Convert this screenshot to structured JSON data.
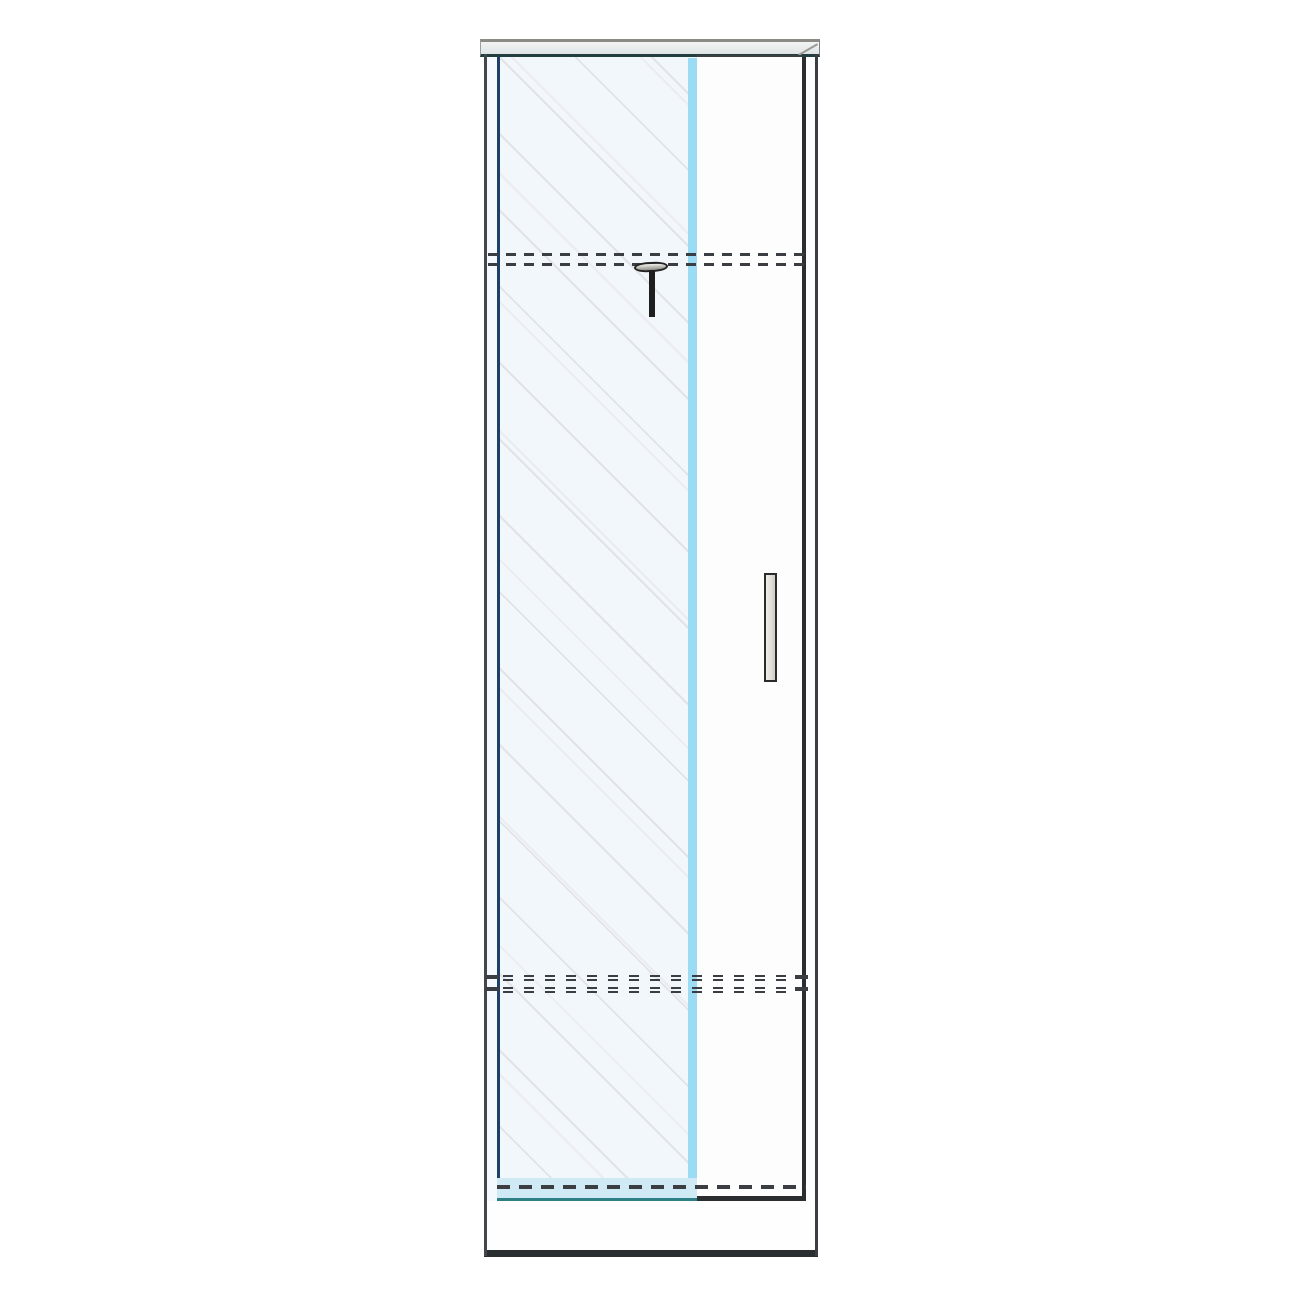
{
  "meta": {
    "description": "Technical line drawing of a tall single wardrobe cabinet with a sliding glass front panel (diagonal hatching), a right-hand hinged door with vertical recessed handle, hidden shelf positions shown as dashed lines, a clothes-rail bracket below the top shelf, a top cap panel and a plinth base.",
    "canvas": {
      "w": 1300,
      "h": 1300,
      "bg": "#ffffff"
    }
  },
  "colors": {
    "outline_dark": "#34383c",
    "navy": "#1d4066",
    "teal": "#2e7f86",
    "glass_fill": "#f2f7fc",
    "glass_band": "#9bdcf4",
    "hatch": "#e2e3e7",
    "cap_fill": "#eaeded",
    "handle_fill": "#e2dfd9",
    "dash": "#3a3e42",
    "rail_blue_fill": "#cfeaf5",
    "white": "#fdfdfd",
    "side_gray": "#43474b"
  },
  "parts": {
    "top_cap": {
      "x": 480,
      "y": 39,
      "w": 340,
      "h": 18
    },
    "cap_bevel": {
      "x": 799,
      "y": 54,
      "w": 22,
      "h": 2
    },
    "left_side_panel": {
      "x": 484,
      "y": 54,
      "w": 3,
      "h": 1202
    },
    "left_side_gap": {
      "x": 487,
      "y": 57,
      "w": 10,
      "h": 1145
    },
    "glass_door": {
      "x": 497,
      "y": 57,
      "w": 200,
      "h": 1145
    },
    "glass_edge_band": {
      "x": 688,
      "y": 58,
      "w": 9,
      "h": 1141
    },
    "right_door": {
      "x": 697,
      "y": 55,
      "w": 105,
      "h": 1147
    },
    "right_inner_edge": {
      "x": 802,
      "y": 57,
      "w": 4,
      "h": 1141
    },
    "right_side_gap": {
      "x": 806,
      "y": 57,
      "w": 9,
      "h": 1145
    },
    "right_side_panel": {
      "x": 815,
      "y": 54,
      "w": 3,
      "h": 1202
    },
    "glass_bottom_rail": {
      "x": 497,
      "y": 1178,
      "w": 200,
      "h": 23
    },
    "right_door_bottom_edge": {
      "x": 697,
      "y": 1196,
      "w": 109,
      "h": 5
    },
    "plinth": {
      "x": 487,
      "y": 1201,
      "w": 328,
      "h": 49
    },
    "bottom_edge": {
      "x": 484,
      "y": 1250,
      "w": 334,
      "h": 7
    },
    "shelf1_dash_upper": {
      "x": 488,
      "y": 253,
      "w": 318,
      "h": 3
    },
    "shelf1_dash_lower": {
      "x": 488,
      "y": 263,
      "w": 318,
      "h": 3
    },
    "shelf2_dash_r1a": {
      "x": 503,
      "y": 975,
      "w": 292,
      "h": 2
    },
    "shelf2_dash_r1b": {
      "x": 503,
      "y": 979,
      "w": 292,
      "h": 2
    },
    "shelf2_dash_r2a": {
      "x": 503,
      "y": 987,
      "w": 292,
      "h": 2
    },
    "shelf2_dash_r2b": {
      "x": 503,
      "y": 991,
      "w": 292,
      "h": 2
    },
    "shelf2_stub_l1": {
      "x": 486,
      "y": 975,
      "w": 13,
      "h": 4
    },
    "shelf2_stub_l2": {
      "x": 486,
      "y": 987,
      "w": 13,
      "h": 4
    },
    "shelf2_stub_r1": {
      "x": 795,
      "y": 975,
      "w": 13,
      "h": 4
    },
    "shelf2_stub_r2": {
      "x": 795,
      "y": 987,
      "w": 13,
      "h": 4
    },
    "shelf3_dash": {
      "x": 497,
      "y": 1185,
      "w": 309,
      "h": 4
    },
    "rail_bracket_cap": {
      "x": 634,
      "y": 262,
      "w": 34,
      "h": 10
    },
    "rail_bracket_stem": {
      "x": 649,
      "y": 270,
      "w": 6,
      "h": 47
    },
    "handle": {
      "x": 764,
      "y": 573,
      "w": 13,
      "h": 109
    }
  }
}
